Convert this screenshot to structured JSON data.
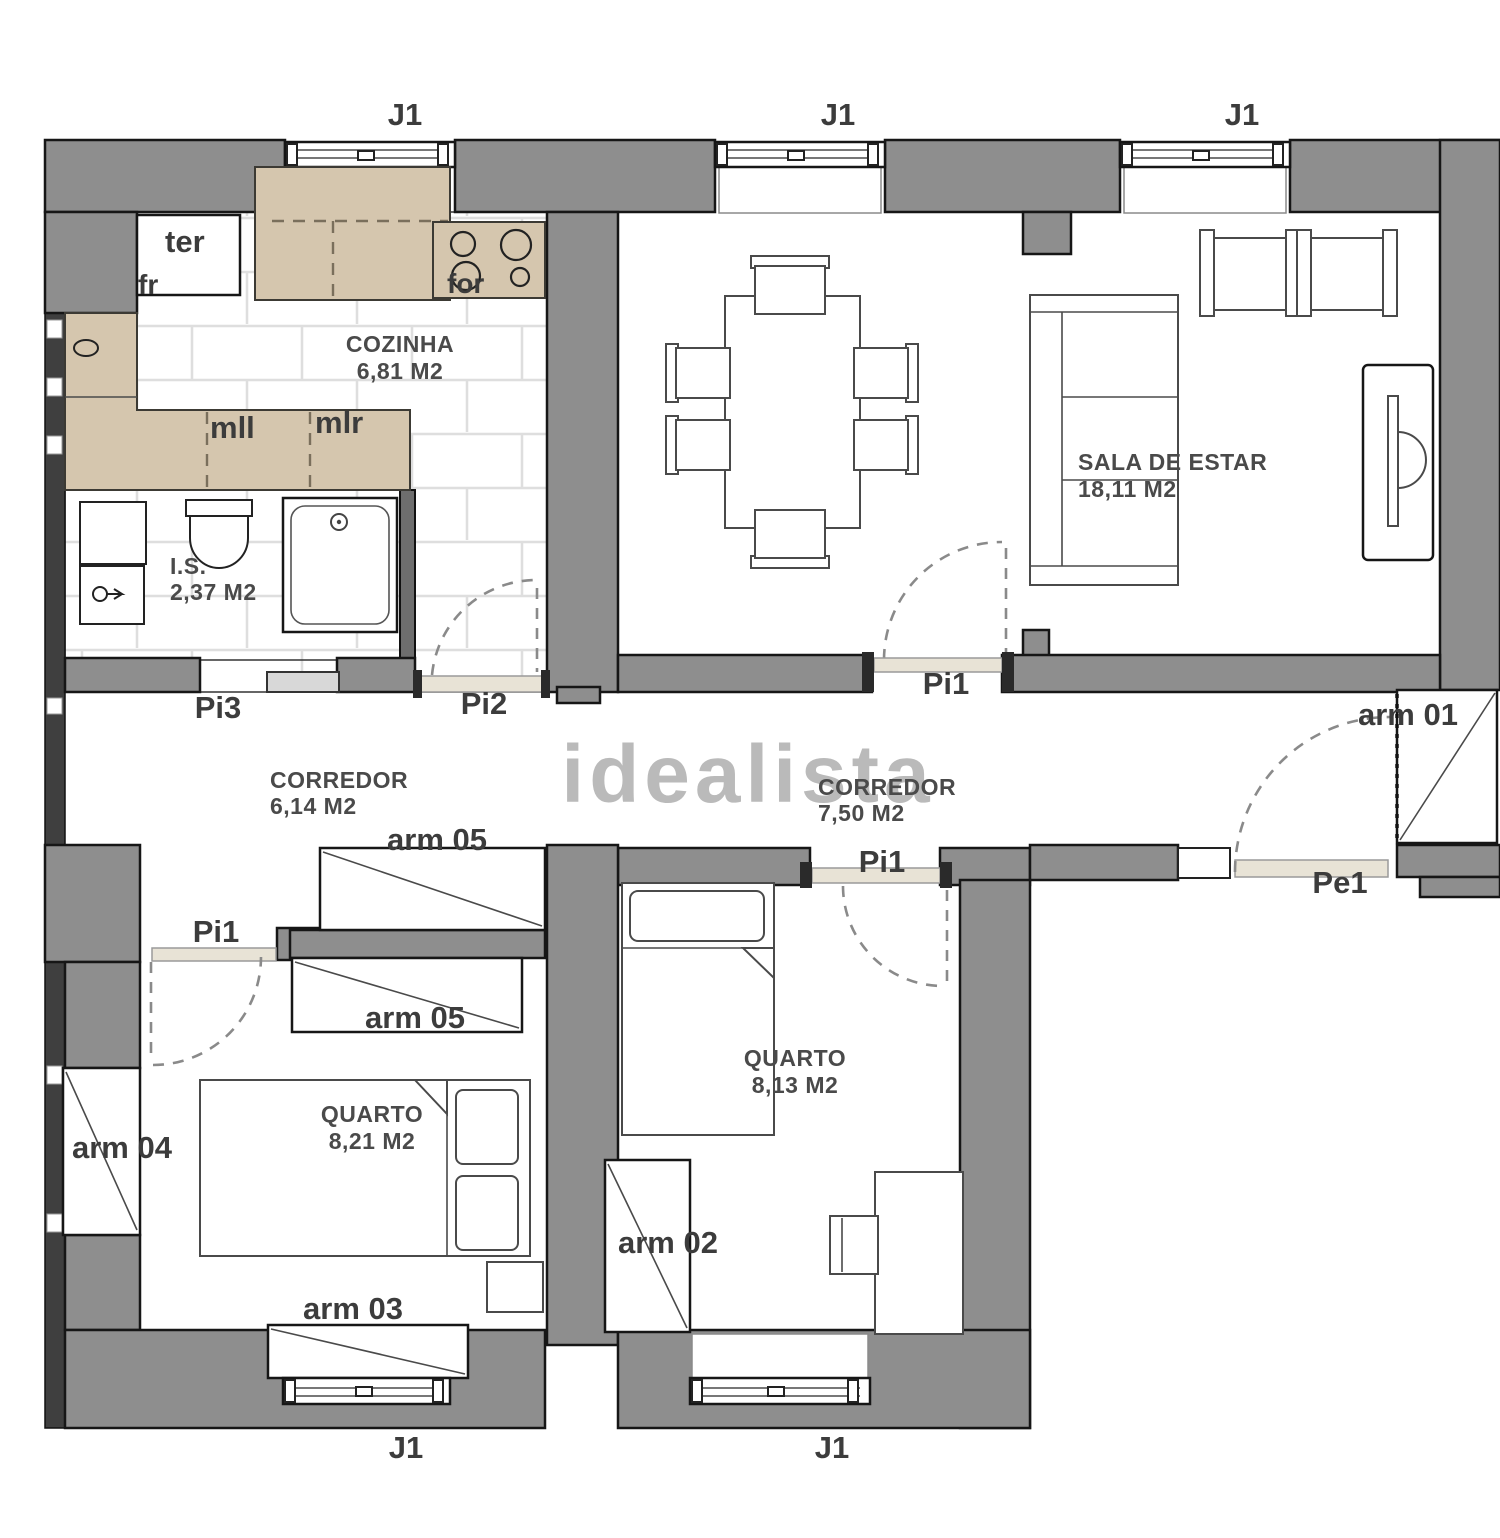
{
  "watermark": "idealista",
  "rooms": {
    "kitchen": {
      "name": "COZINHA",
      "area": "6,81 M2"
    },
    "bathroom": {
      "name": "I.S.",
      "area": "2,37 M2"
    },
    "living": {
      "name": "SALA DE ESTAR",
      "area": "18,11 M2"
    },
    "corridor_a": {
      "name": "CORREDOR",
      "area": "6,14 M2"
    },
    "corridor_b": {
      "name": "CORREDOR",
      "area": "7,50 M2"
    },
    "bedroom_a": {
      "name": "QUARTO",
      "area": "8,21 M2"
    },
    "bedroom_b": {
      "name": "QUARTO",
      "area": "8,13 M2"
    }
  },
  "openings": {
    "window": "J1",
    "door_interior_1": "Pi1",
    "door_interior_2": "Pi2",
    "door_interior_3": "Pi3",
    "door_entrance": "Pe1"
  },
  "wardrobes": {
    "w01": "arm 01",
    "w02": "arm 02",
    "w03": "arm 03",
    "w04": "arm 04",
    "w05": "arm 05"
  },
  "appliances": {
    "water_heater": "ter",
    "fridge": "fr",
    "oven": "for",
    "dishwasher": "mll",
    "washer": "mlr"
  },
  "colors": {
    "wall": "#8e8e8e",
    "wall_dark": "#3f3f3f",
    "counter": "#d5c6ae",
    "outline": "#161616",
    "furniture": "#4a4a4a",
    "tile_line": "#dedede",
    "label": "#3c3c3c",
    "watermark": "#aeaeae",
    "threshold": "#e8e3d6"
  }
}
